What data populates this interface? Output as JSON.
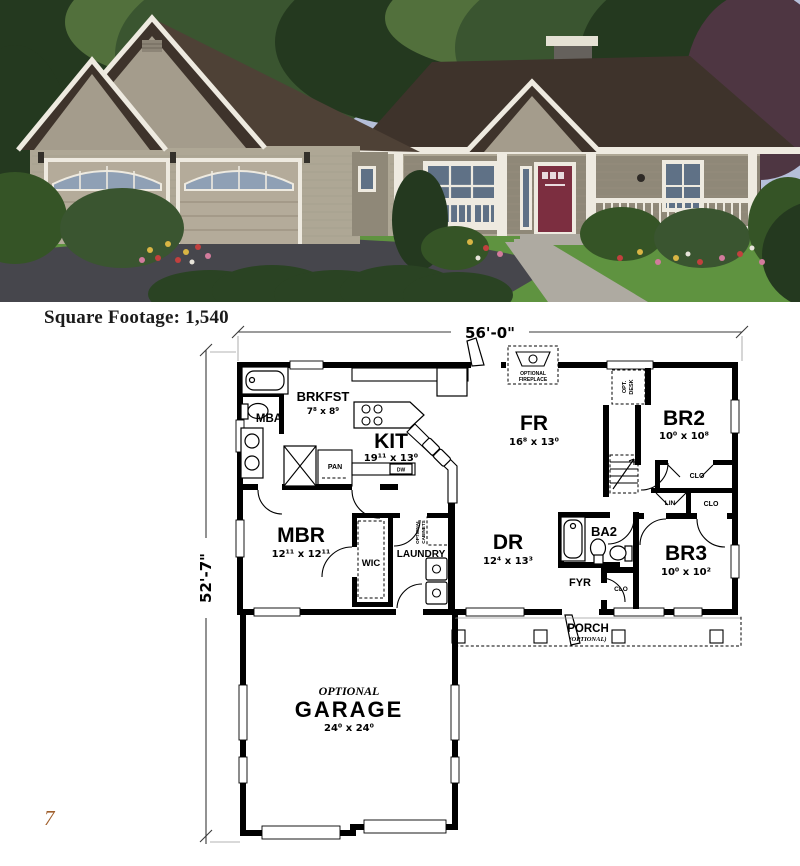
{
  "caption": {
    "label": "Square Footage:",
    "value": "1,540"
  },
  "page": {
    "number": "7"
  },
  "floorplan": {
    "dim_width": "56'-0\"",
    "dim_height": "52'-7\"",
    "rooms": {
      "mba": {
        "name": "MBA"
      },
      "brkfst": {
        "name": "BRKFST",
        "dims": "7⁸ x 8⁹"
      },
      "kit": {
        "name": "KIT",
        "dims": "19¹¹ x 13⁰"
      },
      "fr": {
        "name": "FR",
        "dims": "16⁸ x 13⁰"
      },
      "br2": {
        "name": "BR2",
        "dims": "10⁰ x 10⁸"
      },
      "mbr": {
        "name": "MBR",
        "dims": "12¹¹ x 12¹¹"
      },
      "wic": {
        "name": "WIC"
      },
      "laundry": {
        "name": "LAUNDRY"
      },
      "dr": {
        "name": "DR",
        "dims": "12⁴ x 13³"
      },
      "ba2": {
        "name": "BA2"
      },
      "br3": {
        "name": "BR3",
        "dims": "10⁰ x 10²"
      },
      "fyr": {
        "name": "FYR"
      },
      "porch": {
        "name": "PORCH",
        "note": "(OPTIONAL)"
      },
      "garage": {
        "optional": "OPTIONAL",
        "name": "GARAGE",
        "dims": "24⁰ x 24⁰"
      }
    },
    "labels": {
      "pan": "PAN",
      "dw": "DW",
      "lin": "LIN",
      "clo_br2": "CLO",
      "clo_br3": "CLO",
      "clo_hall": "CLO",
      "opt_desk_1": "OPT.",
      "opt_desk_2": "DESK",
      "fireplace_1": "OPTIONAL",
      "fireplace_2": "FIREPLACE",
      "cabinets_1": "OPTIONAL",
      "cabinets_2": "CABINETS"
    }
  },
  "colors": {
    "sky": "#b5bfd9",
    "tree_dark": "#24391f",
    "tree_mid": "#3a5530",
    "tree_light": "#52703c",
    "tree_maroon": "#4e3642",
    "roof": "#3e332b",
    "roof_light": "#4e4136",
    "gable": "#a49c8c",
    "siding": "#aea795",
    "siding_shade": "#8f8878",
    "trim": "#eeeae0",
    "garage_door": "#b4ab9a",
    "window_glass": "#5f7186",
    "front_door": "#7c2e40",
    "lawn": "#5f9340",
    "driveway": "#46464c",
    "walkway": "#aeaaa1",
    "hedge": "#2a4323",
    "shrub": "#355426",
    "chimney": "#65615c",
    "chimney_cap": "#e5e1d4",
    "flower_red": "#c2403e",
    "flower_pink": "#d27b9c",
    "flower_yellow": "#d9b544",
    "ink": "#000000",
    "page_num": "#a05f2c"
  }
}
